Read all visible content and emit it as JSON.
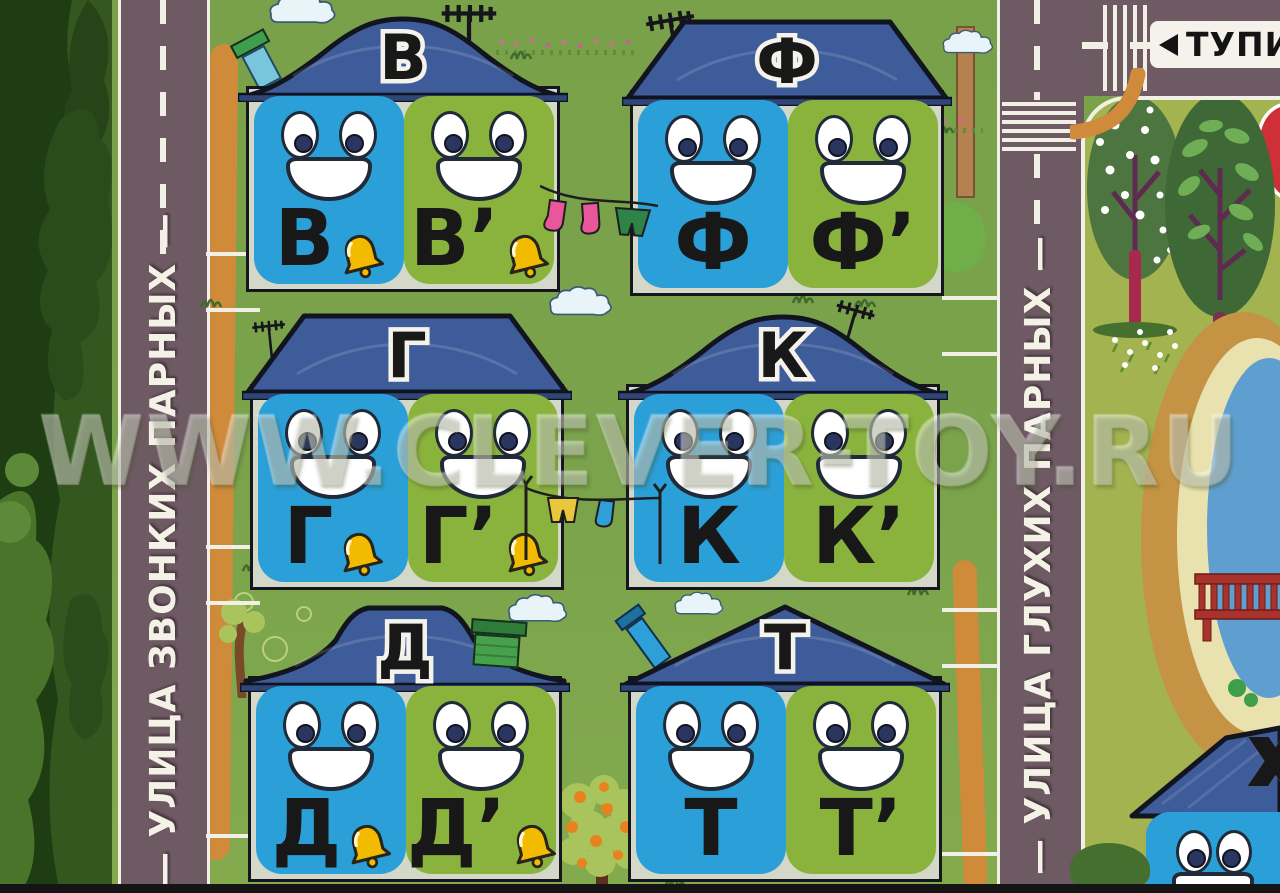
{
  "watermark": "WWW.CLEVER-TOY.RU",
  "streets": {
    "voiced": {
      "label": "— УЛИЦА ЗВОНКИХ ПАРНЫХ —",
      "side": "left"
    },
    "voiceless": {
      "label": "— УЛИЦА ГЛУХИХ ПАРНЫХ —",
      "side": "right"
    }
  },
  "road_sign": {
    "dead_end_label": "ТУПИ",
    "arrow": "left-triangle"
  },
  "houses": [
    {
      "id": "v",
      "roof_letter": "В",
      "hard_letter": "В",
      "soft_letter": "В’",
      "bells": true,
      "voiced": true
    },
    {
      "id": "f",
      "roof_letter": "Ф",
      "hard_letter": "Ф",
      "soft_letter": "Ф’",
      "bells": false,
      "voiced": false
    },
    {
      "id": "g",
      "roof_letter": "Г",
      "hard_letter": "Г",
      "soft_letter": "Г’",
      "bells": true,
      "voiced": true
    },
    {
      "id": "k",
      "roof_letter": "К",
      "hard_letter": "К",
      "soft_letter": "К’",
      "bells": false,
      "voiced": false
    },
    {
      "id": "d",
      "roof_letter": "Д",
      "hard_letter": "Д",
      "soft_letter": "Д’",
      "bells": true,
      "voiced": true
    },
    {
      "id": "t",
      "roof_letter": "Т",
      "hard_letter": "Т",
      "soft_letter": "Т’",
      "bells": false,
      "voiced": false
    }
  ],
  "corner_house": {
    "roof_letter": "Х"
  },
  "colors": {
    "card_blue": "#2b9fd8",
    "card_green": "#8ab33e",
    "roof_blue": "#3d5c99",
    "street_asphalt": "#6e5a63",
    "road_marking": "#f2efe6",
    "bell_gold": "#f3bb00",
    "grass_main": "#7ba049",
    "grass_park": "#a3b350",
    "pond_water": "#5f9fd0",
    "bench_red": "#a8322c",
    "path_orange": "#cf8a3a"
  }
}
